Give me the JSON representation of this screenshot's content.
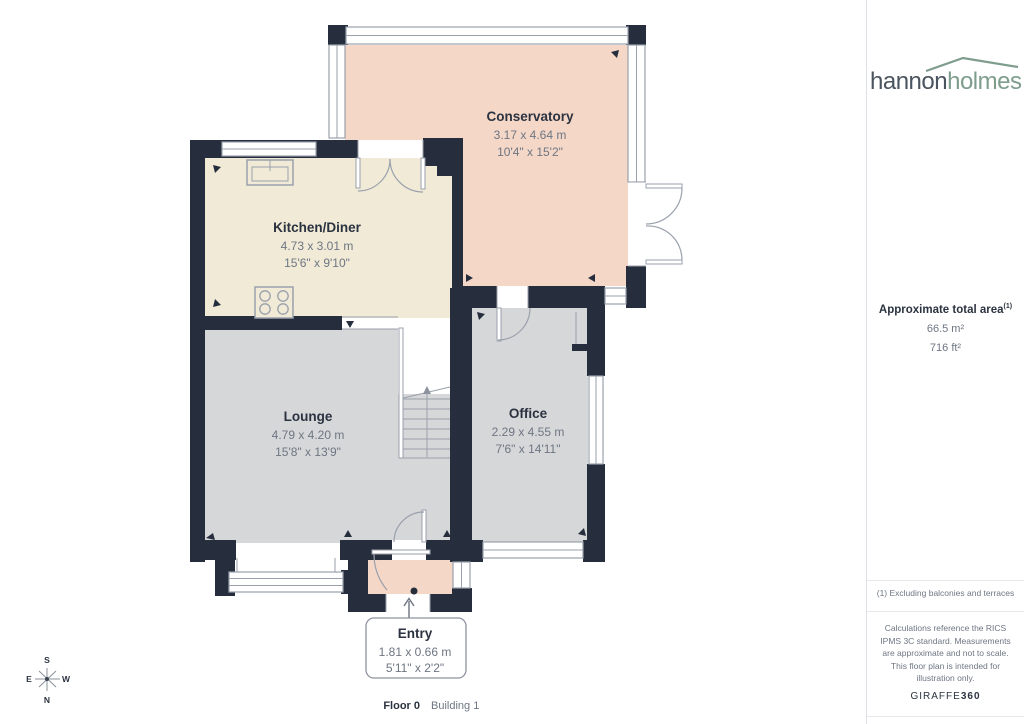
{
  "branding": {
    "name_left": "hannon",
    "name_right": "holmes"
  },
  "sidebar": {
    "total_area_label": "Approximate total area",
    "total_area_superscript": "(1)",
    "area_m2": "66.5 m²",
    "area_ft2": "716 ft²",
    "footnote": "(1) Excluding balconies and terraces",
    "disclaimer": "Calculations reference the RICS IPMS 3C standard. Measurements are approximate and not to scale. This floor plan is intended for illustration only.",
    "brand_name": "GIRAFFE",
    "brand_suffix": "360"
  },
  "floorplan": {
    "rooms": [
      {
        "name": "Conservatory",
        "metric": "3.17 x 4.64 m",
        "imperial": "10'4\" x 15'2\""
      },
      {
        "name": "Kitchen/Diner",
        "metric": "4.73 x 3.01 m",
        "imperial": "15'6\" x 9'10\""
      },
      {
        "name": "Lounge",
        "metric": "4.79 x 4.20 m",
        "imperial": "15'8\" x 13'9\""
      },
      {
        "name": "Office",
        "metric": "2.29 x 4.55 m",
        "imperial": "7'6\" x 14'11\""
      },
      {
        "name": "Entry",
        "metric": "1.81 x 0.66 m",
        "imperial": "5'11\" x 2'2\""
      }
    ],
    "palette": {
      "wall": "#262e3d",
      "conservatory_fill": "#f4d7c7",
      "kitchen_fill": "#f0ead6",
      "gray_room_fill": "#d6d7d9",
      "fixture_line": "#9aa1ac"
    }
  },
  "compass": {
    "north": "N",
    "south": "S",
    "east": "E",
    "west": "W"
  },
  "footer": {
    "floor": "Floor 0",
    "building": "Building 1"
  }
}
